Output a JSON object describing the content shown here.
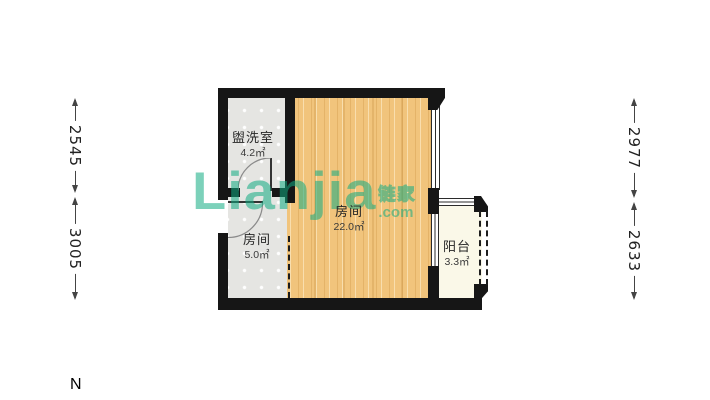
{
  "plan": {
    "rooms": {
      "washroom": {
        "name": "盥洗室",
        "area": "4.2㎡"
      },
      "main": {
        "name": "房间",
        "area": "22.0㎡"
      },
      "small": {
        "name": "房间",
        "area": "5.0㎡"
      },
      "balcony": {
        "name": "阳台",
        "area": "3.3㎡"
      }
    }
  },
  "dimensions": {
    "left_top": "2545",
    "left_bottom": "3005",
    "right_top": "2977",
    "right_bottom": "2633"
  },
  "compass": {
    "north_label": "N"
  },
  "watermark": {
    "brand": "Lianjia",
    "tld": ".com",
    "cjk": "链家"
  },
  "colors": {
    "wall": "#161616",
    "wood_floor": "#F1C47C",
    "tile_floor": "#E5E5E2",
    "balcony_floor": "#FAF8E8",
    "watermark_teal": "#10AC82"
  }
}
